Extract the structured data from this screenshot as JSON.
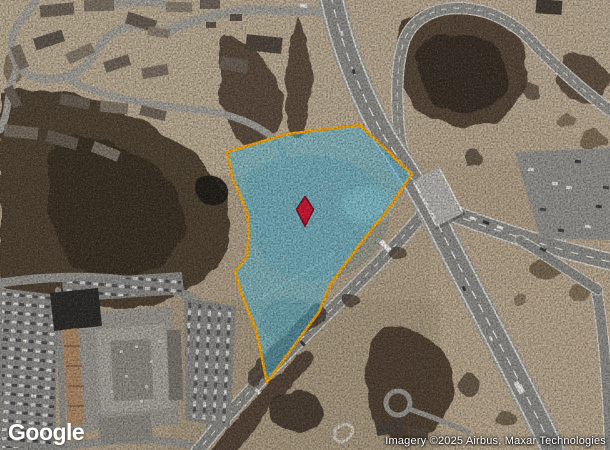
{
  "map": {
    "provider_logo": "Google",
    "attribution": "Imagery ©2025 Airbus, Maxar Technologies"
  },
  "parcel": {
    "points": "227,152 287,134 360,125 412,174 386,212 363,240 331,283 319,312 267,382 256,330 242,295 235,272 247,257 249,232 247,212 240,195 233,180",
    "fill_color": "#55c3e8",
    "fill_opacity": "0.52",
    "stroke_color": "#ffa800",
    "stroke_width": "2.6"
  },
  "marker": {
    "path": "M305,196.5 L313.5,209.5 L305,226 L296.5,209.5 Z",
    "fill_color": "#d21535",
    "stroke_color": "#7d0a18",
    "stroke_width": "1.6"
  }
}
